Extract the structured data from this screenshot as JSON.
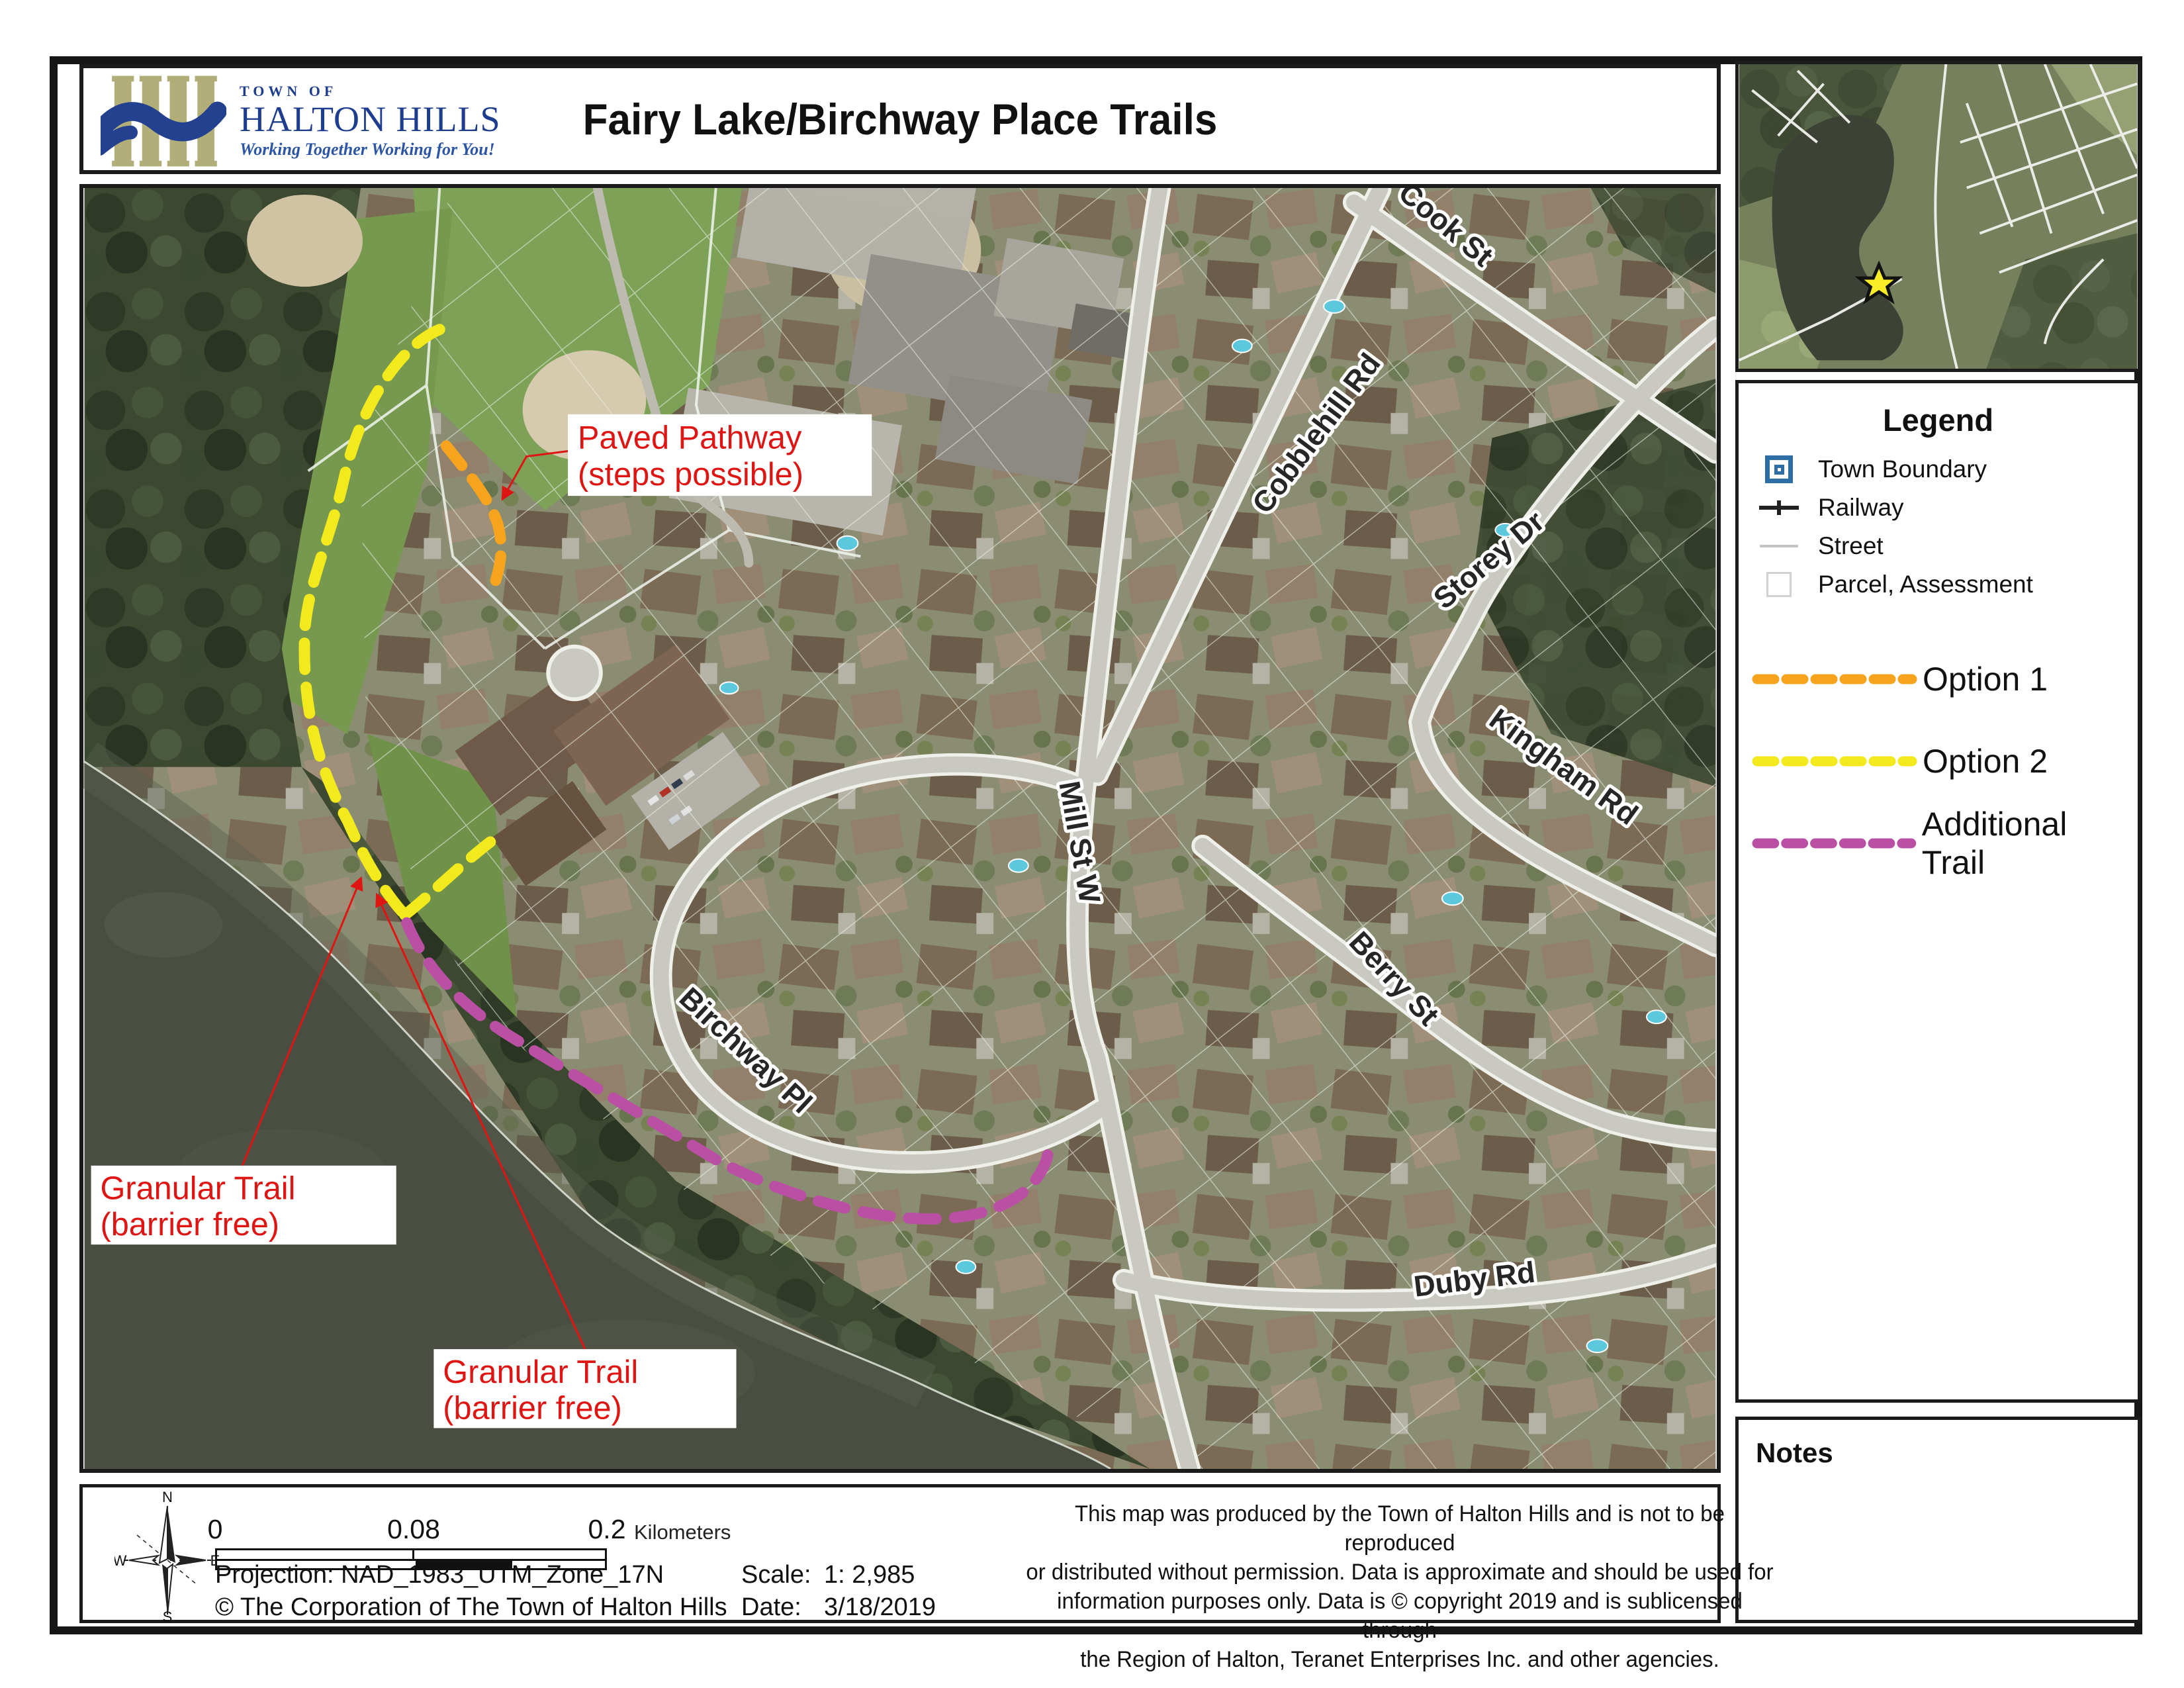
{
  "header": {
    "title": "Fairy Lake/Birchway Place Trails",
    "logo": {
      "town_of": "TOWN OF",
      "name": "HALTON HILLS",
      "tagline": "Working Together Working for You!"
    }
  },
  "legend": {
    "title": "Legend",
    "items": [
      {
        "label": "Town Boundary"
      },
      {
        "label": "Railway"
      },
      {
        "label": "Street"
      },
      {
        "label": "Parcel, Assessment"
      }
    ],
    "trail_items": [
      {
        "label": "Option 1",
        "color": "#F6A41E"
      },
      {
        "label": "Option 2",
        "color": "#F2EA1C"
      },
      {
        "label": "Additional Trail",
        "color": "#BA50A4"
      }
    ]
  },
  "notes": {
    "title": "Notes"
  },
  "map": {
    "callout_color": "#DE1512",
    "callouts": {
      "paved": {
        "line1": "Paved Pathway",
        "line2": "(steps possible)"
      },
      "granular1": {
        "line1": "Granular Trail",
        "line2": "(barrier free)"
      },
      "granular2": {
        "line1": "Granular Trail",
        "line2": "(barrier free)"
      }
    },
    "streets": [
      "Cook St",
      "Cobblehill Rd",
      "Storey Dr",
      "Mill St W",
      "Kingham Rd",
      "Berry St",
      "Birchway Pl",
      "Duby Rd"
    ]
  },
  "inset": {
    "star_color": "#F9ED27"
  },
  "footer": {
    "compass": {
      "n": "N",
      "e": "E",
      "s": "S",
      "w": "W"
    },
    "scale_bar": {
      "ticks": [
        "0",
        "0.08",
        "0.2"
      ],
      "unit": "Kilometers"
    },
    "projection": "Projection:  NAD_1983_UTM_Zone_17N",
    "copyright": "© The Corporation of The Town of Halton Hills",
    "scale_label": "Scale:",
    "scale_value": "1: 2,985",
    "date_label": "Date:",
    "date_value": "3/18/2019",
    "disclaimer": [
      "This map was produced by the Town of Halton Hills and is not to be reproduced",
      "or distributed without permission. Data is approximate and should be used for",
      "information purposes only. Data is © copyright 2019 and is sublicensed through",
      "the Region of Halton, Teranet Enterprises Inc. and other agencies."
    ]
  }
}
